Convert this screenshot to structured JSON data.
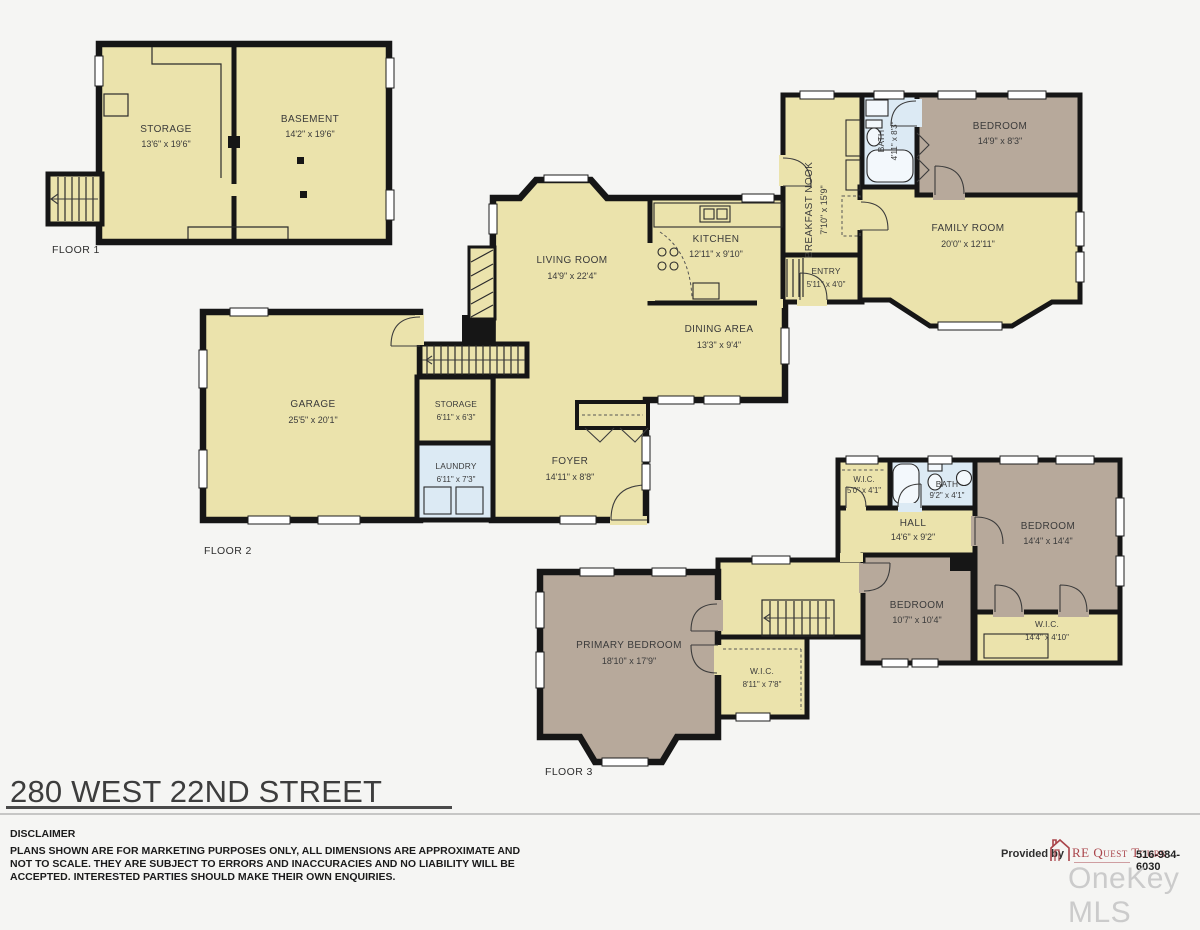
{
  "title": "280 WEST 22ND STREET",
  "disclaimer": {
    "heading": "DISCLAIMER",
    "lines": [
      "PLANS SHOWN ARE FOR MARKETING PURPOSES ONLY, ALL DIMENSIONS ARE APPROXIMATE AND",
      "NOT TO SCALE. THEY ARE SUBJECT TO ERRORS AND INACCURACIES AND NO LIABILITY WILL BE",
      "ACCEPTED. INTERESTED PARTIES SHOULD MAKE THEIR OWN ENQUIRIES."
    ]
  },
  "provider": {
    "prefix": "Provided by",
    "brand": "RE Quest Tours",
    "phone": "516-984-6030"
  },
  "watermark": "OneKey MLS",
  "floors": [
    {
      "label": "FLOOR 1",
      "rooms": [
        {
          "name": "STORAGE",
          "dims": "13'6\" x 19'6\""
        },
        {
          "name": "BASEMENT",
          "dims": "14'2\" x 19'6\""
        }
      ]
    },
    {
      "label": "FLOOR 2",
      "rooms": [
        {
          "name": "BREAKFAST NOOK",
          "dims": "7'10\" x 15'9\""
        },
        {
          "name": "BATH",
          "dims": "4'11\" x 8'3\""
        },
        {
          "name": "BEDROOM",
          "dims": "14'9\" x 8'3\""
        },
        {
          "name": "FAMILY ROOM",
          "dims": "20'0\" x 12'11\""
        },
        {
          "name": "KITCHEN",
          "dims": "12'11\" x 9'10\""
        },
        {
          "name": "ENTRY",
          "dims": "5'11\" x 4'0\""
        },
        {
          "name": "LIVING ROOM",
          "dims": "14'9\" x 22'4\""
        },
        {
          "name": "DINING AREA",
          "dims": "13'3\" x 9'4\""
        },
        {
          "name": "GARAGE",
          "dims": "25'5\" x 20'1\""
        },
        {
          "name": "STORAGE",
          "dims": "6'11\" x 6'3\""
        },
        {
          "name": "LAUNDRY",
          "dims": "6'11\" x 7'3\""
        },
        {
          "name": "FOYER",
          "dims": "14'11\" x 8'8\""
        }
      ]
    },
    {
      "label": "FLOOR 3",
      "rooms": [
        {
          "name": "W.I.C.",
          "dims": "5'0\" x 4'1\""
        },
        {
          "name": "BATH",
          "dims": "9'2\" x 4'1\""
        },
        {
          "name": "HALL",
          "dims": "14'6\" x 9'2\""
        },
        {
          "name": "BEDROOM",
          "dims": "14'4\" x 14'4\""
        },
        {
          "name": "BEDROOM",
          "dims": "10'7\" x 10'4\""
        },
        {
          "name": "W.I.C.",
          "dims": "14'4\" x 4'10\""
        },
        {
          "name": "PRIMARY BEDROOM",
          "dims": "18'10\" x 17'9\""
        },
        {
          "name": "W.I.C.",
          "dims": "8'11\" x 7'8\""
        }
      ]
    }
  ],
  "colors": {
    "room_fill": "#EBE3AC",
    "bedroom_fill": "#B7A99B",
    "bath_fill": "#DCEAF4",
    "wall": "#161616",
    "brand_red": "#A9444A",
    "watermark_gray": "#CBCBCB"
  }
}
